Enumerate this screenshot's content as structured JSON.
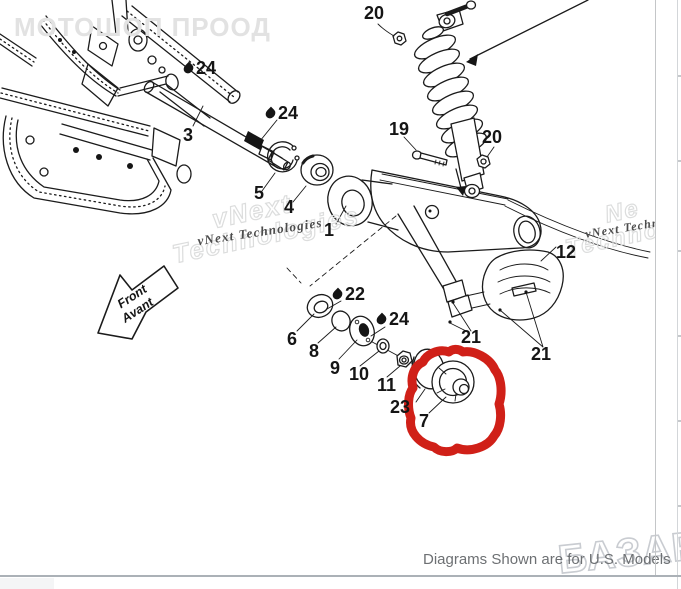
{
  "caption": "Diagrams Shown are for U.S. Models",
  "watermarks": {
    "top_left": "МОТОШОП ПРООД",
    "vnext_small": "vNext Technologies",
    "vnext_outline_word1": "vNext",
    "vnext_outline_word2": "Technologies",
    "vnext_small_right": "vNext Techn",
    "vnext_outline_right_word1": "Ne",
    "vnext_outline_right_word2": "Techno",
    "marketplace": "БАЗАР"
  },
  "direction_arrow": {
    "line1": "Front",
    "line2": "Avant"
  },
  "colors": {
    "red_highlight": "#d02018",
    "line": "#1b1b1b",
    "caption_gray": "#6d7073",
    "watermark_gray": "#e2e2e2"
  },
  "callouts": [
    {
      "label": "20",
      "lubricate": false
    },
    {
      "label": "19",
      "lubricate": false
    },
    {
      "label": "20",
      "lubricate": false
    },
    {
      "label": "24",
      "lubricate": true
    },
    {
      "label": "3",
      "lubricate": false
    },
    {
      "label": "24",
      "lubricate": true
    },
    {
      "label": "5",
      "lubricate": false
    },
    {
      "label": "4",
      "lubricate": false
    },
    {
      "label": "1",
      "lubricate": false
    },
    {
      "label": "12",
      "lubricate": false
    },
    {
      "label": "21",
      "lubricate": false
    },
    {
      "label": "21",
      "lubricate": false
    },
    {
      "label": "22",
      "lubricate": true
    },
    {
      "label": "6",
      "lubricate": false
    },
    {
      "label": "8",
      "lubricate": false
    },
    {
      "label": "9",
      "lubricate": false
    },
    {
      "label": "10",
      "lubricate": false
    },
    {
      "label": "24",
      "lubricate": true
    },
    {
      "label": "11",
      "lubricate": false
    },
    {
      "label": "23",
      "lubricate": false
    },
    {
      "label": "7",
      "lubricate": false
    }
  ]
}
